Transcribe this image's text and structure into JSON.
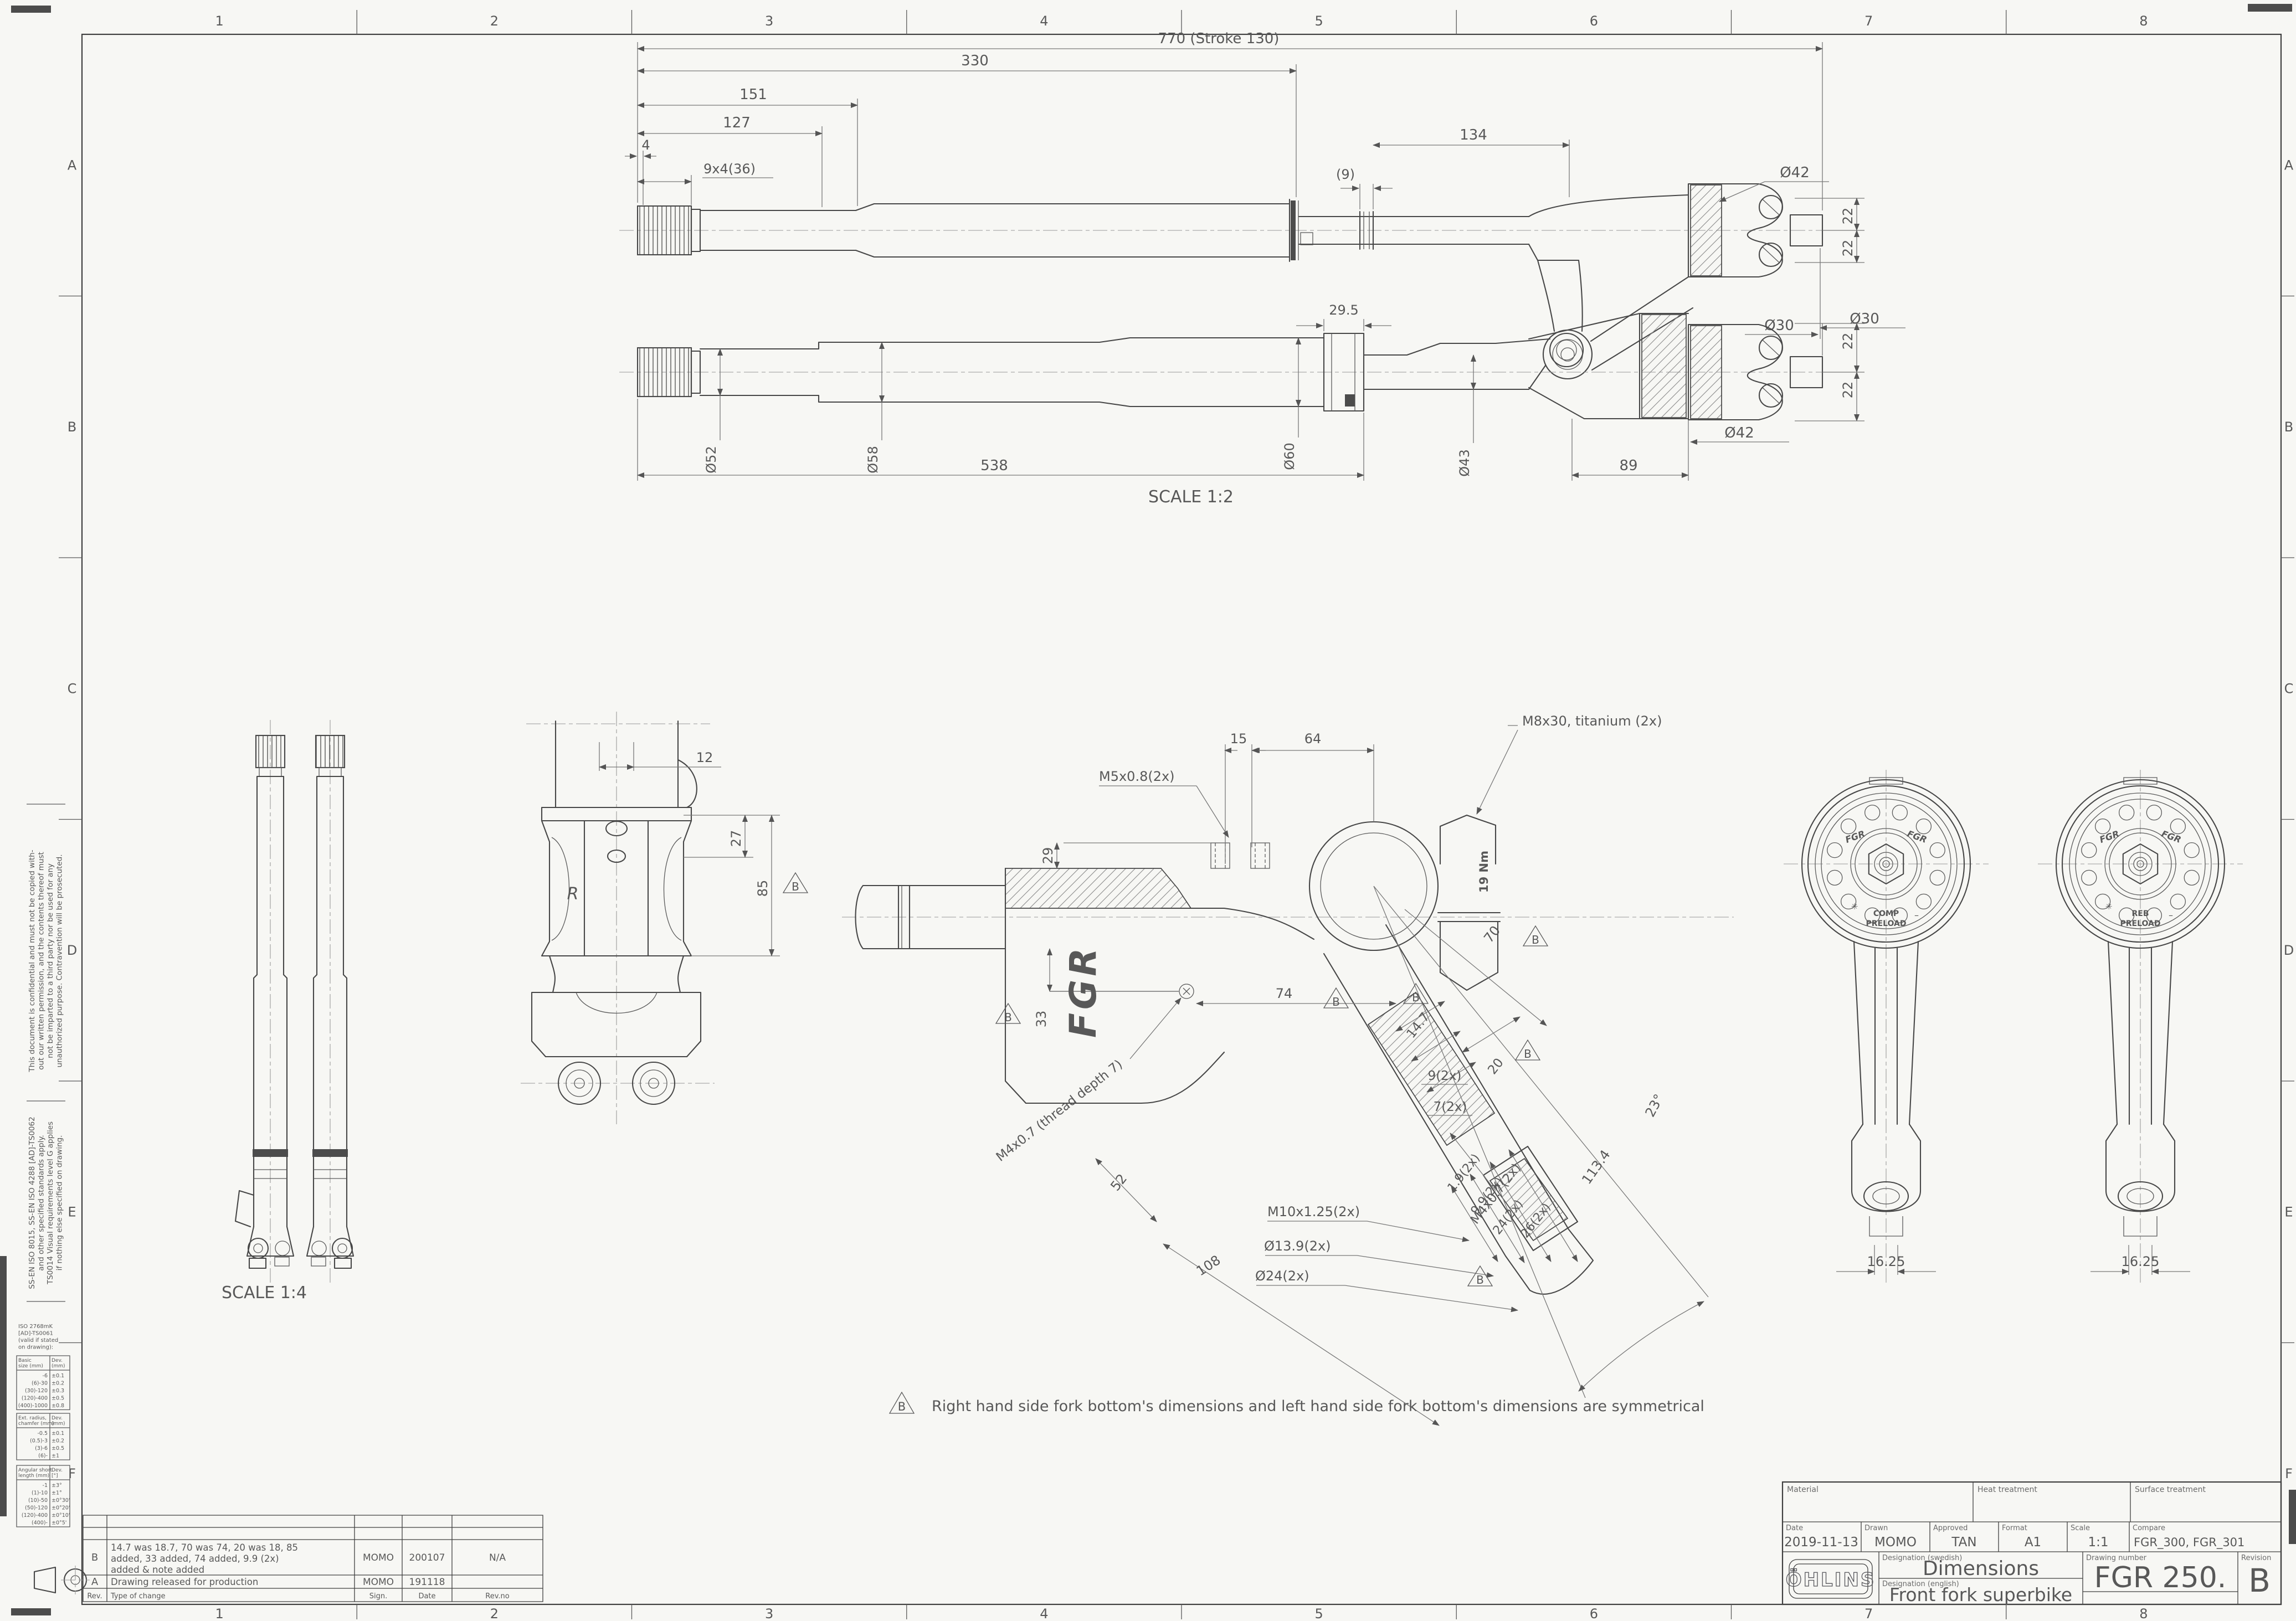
{
  "sheet": {
    "cols": [
      "1",
      "2",
      "3",
      "4",
      "5",
      "6",
      "7",
      "8"
    ],
    "rows": [
      "A",
      "B",
      "C",
      "D",
      "E",
      "F"
    ],
    "scale_main": "SCALE 1:2",
    "scale_legs": "SCALE 1:4",
    "note_symbol": "B",
    "note_text": "Right hand side fork bottom's dimensions and left hand side fork bottom's dimensions are symmetrical"
  },
  "fork_top": {
    "overall": "770 (Stroke 130)",
    "l330": "330",
    "l151": "151",
    "l127": "127",
    "l4": "4",
    "thread": "9x4(36)",
    "g9": "(9)",
    "l134": "134",
    "d42": "Ø42",
    "t22a": "22",
    "t22b": "22",
    "d30": "Ø30"
  },
  "fork_bottom": {
    "l295": "29.5",
    "d52": "Ø52",
    "d58": "Ø58",
    "d60": "Ø60",
    "d43": "Ø43",
    "d42": "Ø42",
    "d30": "Ø30",
    "t22a": "22",
    "t22b": "22",
    "l538": "538",
    "l89": "89"
  },
  "front_view": {
    "l12": "12",
    "l27": "27",
    "l85": "85",
    "b": "B",
    "logo": "R"
  },
  "center_view": {
    "l29": "29",
    "l15": "15",
    "l64": "64",
    "m5": "M5x0.8(2x)",
    "m8": "M8x30, titanium (2x)",
    "nm": "19 Nm",
    "l33": "33",
    "m4t": "M4x0.7 (thread depth 7)",
    "l74": "74",
    "l70": "70",
    "l147": "14.7",
    "l20": "20",
    "l9": "9(2x)",
    "l7": "7(2x)",
    "m4": "M4x0.7(2x)",
    "l19": "1.9(2x)",
    "l99": "9.9(2x)",
    "l24": "24(2x)",
    "l26": "26(2x)",
    "m10": "M10x1.25(2x)",
    "d139": "Ø13.9(2x)",
    "d24": "Ø24(2x)",
    "l52": "52",
    "l108": "108",
    "l1134": "113.4",
    "a23": "23°",
    "b": "B",
    "fgr": "FGR"
  },
  "adjusters": {
    "logo": "FGR",
    "star": "✳",
    "dash": "–",
    "left_line1": "COMP",
    "left_line2": "PRELOAD",
    "right_line1": "REB",
    "right_line2": "PRELOAD",
    "dim": "16.25"
  },
  "margin": {
    "confidential": [
      "This document is confidential and must not be copied with-",
      "out our written permission, and the contents thereof must",
      "not be imparted to a third party nor be used for any",
      "unauthorized purpose. Contravention will be prosecuted."
    ],
    "standards": [
      "SS-EN ISO 8015, SS-EN ISO 4288 [AD]-TS0062",
      "and other specified standards apply.",
      "TS0014 Visual requirements level G applies",
      "if nothing else specified on drawing."
    ]
  },
  "tolerances": {
    "note": [
      "ISO 2768mK",
      "[AD]-TS0061",
      "(valid if stated",
      "on drawing):"
    ],
    "basic": {
      "h1": "Basic",
      "h1b": "size (mm)",
      "h2": "Dev.",
      "h2b": "(mm)",
      "rows": [
        [
          "-6",
          "±0.1"
        ],
        [
          "(6)-30",
          "±0.2"
        ],
        [
          "(30)-120",
          "±0.3"
        ],
        [
          "(120)-400",
          "±0.5"
        ],
        [
          "(400)-1000",
          "±0.8"
        ]
      ]
    },
    "radius": {
      "h1": "Ext. radius,",
      "h1b": "chamfer (mm)",
      "h2": "Dev.",
      "h2b": "(mm)",
      "rows": [
        [
          "-0.5",
          "±0.1"
        ],
        [
          "(0.5)-3",
          "±0.2"
        ],
        [
          "(3)-6",
          "±0.5"
        ],
        [
          "(6)-",
          "±1"
        ]
      ]
    },
    "angular": {
      "h1": "Angular short",
      "h1b": "length (mm)",
      "h2": "Dev.",
      "h2b": "[°]",
      "rows": [
        [
          "-1",
          "±3°"
        ],
        [
          "(1)-10",
          "±1°"
        ],
        [
          "(10)-50",
          "±0°30'"
        ],
        [
          "(50)-120",
          "±0°20'"
        ],
        [
          "(120)-400",
          "±0°10'"
        ],
        [
          "(400)-",
          "±0°5'"
        ]
      ]
    }
  },
  "revisions": {
    "headers": {
      "rev": "Rev.",
      "change": "Type of change",
      "sign": "Sign.",
      "date": "Date",
      "revno": "Rev.no"
    },
    "rows": [
      {
        "rev": "B",
        "lines": [
          "14.7 was 18.7, 70 was 74, 20 was 18, 85",
          "added, 33 added, 74 added, 9.9 (2x)",
          "added  & note added"
        ],
        "sign": "MOMO",
        "date": "200107",
        "revno": "N/A"
      },
      {
        "rev": "A",
        "lines": [
          "Drawing released for production"
        ],
        "sign": "MOMO",
        "date": "191118",
        "revno": ""
      }
    ]
  },
  "title_block": {
    "labels": {
      "material": "Material",
      "heat": "Heat treatment",
      "surface": "Surface treatment",
      "date": "Date",
      "drawn": "Drawn",
      "approved": "Approved",
      "format": "Format",
      "scale": "Scale",
      "compare": "Compare",
      "designation_sv": "Designation (swedish)",
      "designation_en": "Designation (english)",
      "drawing_number": "Drawing number",
      "revision": "Revision"
    },
    "logo": "ÖHLINS",
    "date": "2019-11-13",
    "drawn": "MOMO",
    "approved": "TAN",
    "format": "A1",
    "scale": "1:1",
    "compare": "FGR_300, FGR_301",
    "designation_sv": "Dimensions",
    "designation_en": "Front fork superbike",
    "drawing_number": "FGR 250.",
    "revision": "B"
  }
}
